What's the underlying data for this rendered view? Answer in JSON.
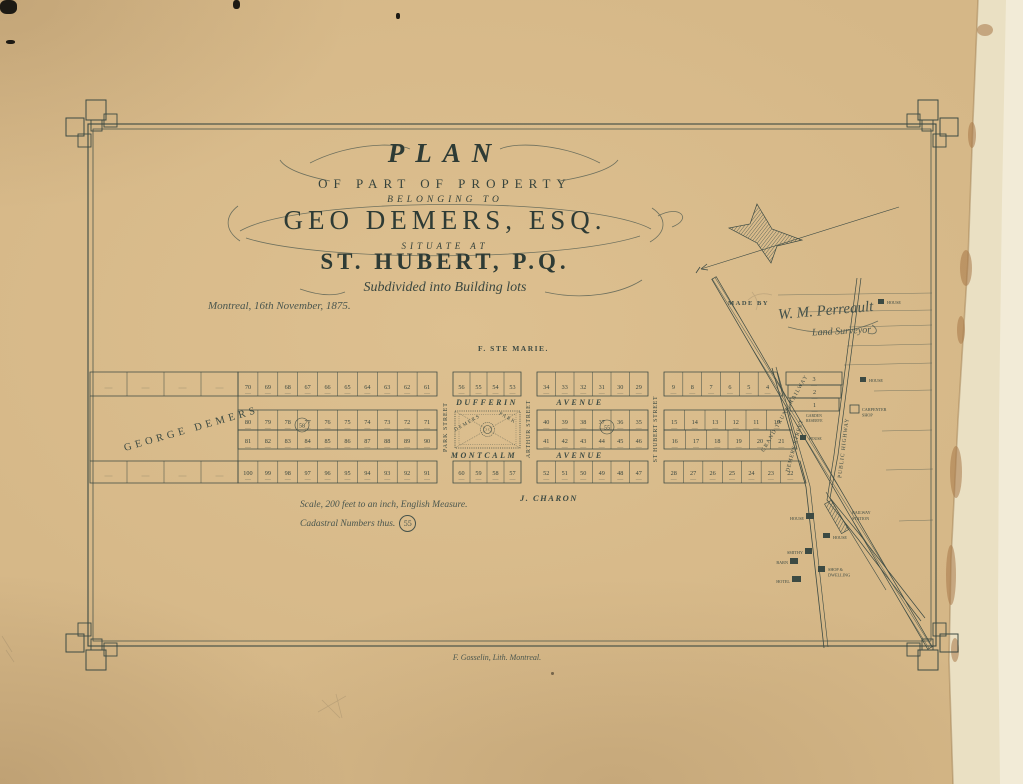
{
  "document": {
    "title_line1": "PLAN",
    "title_line2": "OF PART OF PROPERTY",
    "title_line3": "BELONGING TO",
    "owner": "GEO DEMERS, ESQ.",
    "situate_label": "SITUATE AT",
    "place": "ST. HUBERT, P.Q.",
    "subtitle": "Subdivided into Building lots",
    "date_line": "Montreal, 16th November, 1875.",
    "made_by_label": "MADE BY",
    "surveyor_signature": "W. M. Perreault",
    "surveyor_title": "Land Surveyor",
    "scale_note": "Scale, 200 feet to an inch, English Measure.",
    "cadastral_note": "Cadastral Numbers thus.",
    "cadastral_example": "55",
    "lithographer": "F. Gosselin, Lith. Montreal."
  },
  "map": {
    "adjoining_north": "F. STE MARIE.",
    "adjoining_south": "J. CHARON",
    "owner_block_label": "GEORGE DEMERS",
    "park_label_1": "DEMERS",
    "park_label_2": "PARK",
    "streets": {
      "park": "PARK STREET",
      "arthur": "ARTHUR STREET",
      "st_hubert": "ST HUBERT STREET",
      "demers": "DEMERS STREET",
      "dufferin_w": "DUFFERIN",
      "dufferin_e": "AVENUE",
      "montcalm_w": "MONTCALM",
      "montcalm_e": "AVENUE",
      "railway": "GRAND TRUNK RAILWAY",
      "highway": "PUBLIC HIGHWAY"
    },
    "cadastral_circles": {
      "block_b": "58",
      "block_d": "55"
    },
    "lots": {
      "b1": [
        "70",
        "69",
        "68",
        "67",
        "66",
        "65",
        "64",
        "63",
        "62",
        "61"
      ],
      "b2": [
        "80",
        "79",
        "78",
        "77",
        "76",
        "75",
        "74",
        "73",
        "72",
        "71"
      ],
      "b3": [
        "81",
        "82",
        "83",
        "84",
        "85",
        "86",
        "87",
        "88",
        "89",
        "90"
      ],
      "b4": [
        "100",
        "99",
        "98",
        "97",
        "96",
        "95",
        "94",
        "93",
        "92",
        "91"
      ],
      "c1": [
        "56",
        "55",
        "54",
        "53"
      ],
      "c4": [
        "60",
        "59",
        "58",
        "57"
      ],
      "d1": [
        "34",
        "33",
        "32",
        "31",
        "30",
        "29"
      ],
      "d2": [
        "40",
        "39",
        "38",
        "37",
        "36",
        "35"
      ],
      "d3": [
        "41",
        "42",
        "43",
        "44",
        "45",
        "46"
      ],
      "d4": [
        "52",
        "51",
        "50",
        "49",
        "48",
        "47"
      ],
      "e1": [
        "9",
        "8",
        "7",
        "6",
        "5",
        "4"
      ],
      "e2": [
        "15",
        "14",
        "13",
        "12",
        "11",
        "10"
      ],
      "e3": [
        "16",
        "17",
        "18",
        "19",
        "20",
        "21"
      ],
      "e4": [
        "28",
        "27",
        "26",
        "25",
        "24",
        "23",
        "22"
      ],
      "o1": [
        "3"
      ],
      "o2": [
        "2"
      ],
      "o3": [
        "1"
      ]
    },
    "buildings": {
      "house_a": "HOUSE",
      "railway_station_1": "RAILWAY",
      "railway_station_2": "STATION",
      "house_b": "HOUSE",
      "smithy": "SMITHY",
      "barn": "BARN",
      "shop_dwelling_1": "SHOP &",
      "shop_dwelling_2": "DWELLING",
      "hotel": "HOTEL",
      "house_c": "HOUSE",
      "house_d": "HOUSE",
      "carpenter_1": "CARPENTER",
      "carpenter_2": "SHOP",
      "garden_1": "GARDEN",
      "garden_2": "RESERVE",
      "house_e": "HOUSE"
    }
  },
  "colors": {
    "paper": "#d5b787",
    "ink": "#3c4a43",
    "tear_strip": "#eae0c3",
    "stain": "#a87848"
  }
}
